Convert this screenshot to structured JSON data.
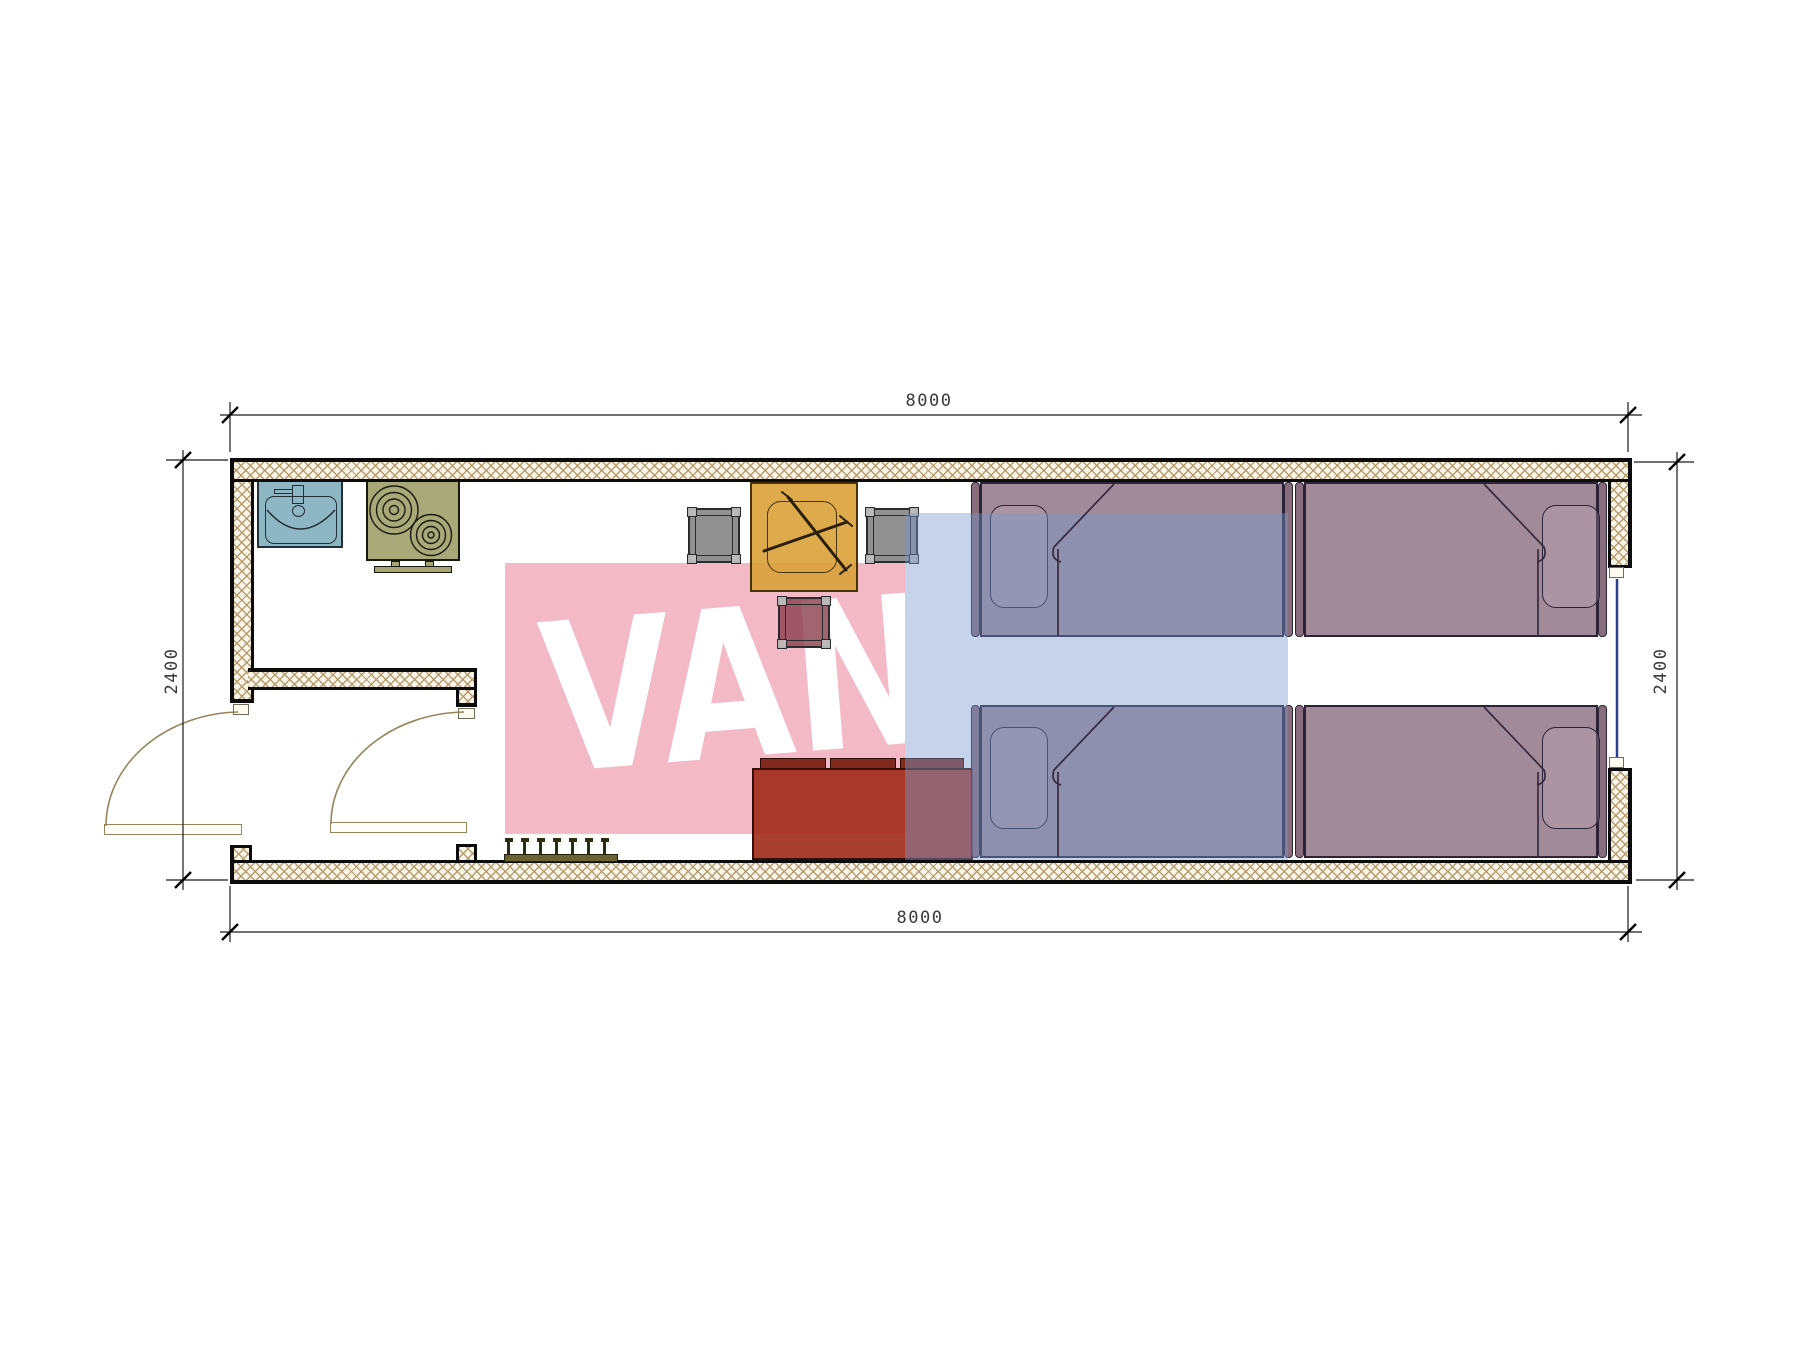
{
  "plan": {
    "title": "container-house-floor-plan",
    "dimensions": {
      "top_mm": "8000",
      "bottom_mm": "8000",
      "left_mm": "2400",
      "right_mm": "2400"
    },
    "watermark": {
      "word": "VANDA",
      "left_text": "VAN",
      "right_text": "DA",
      "pink_block": "#f4b9c6",
      "blue_block_rgba": "rgba(120,150,205,0.42)",
      "letter_color": "#ffffff"
    },
    "palette": {
      "wall_bg": "#faf5e8",
      "wall_hatch": "#b09a6a",
      "ink": "#0c0c0c",
      "pink": "#f4b9c6",
      "sink": "#89b2c0",
      "stove": "#a6a472",
      "table": "#daa238",
      "chair_gray": "#828282",
      "chair_red": "#8c4252",
      "sofa": "#9e2a18",
      "bed": "#8a6e7e",
      "window": "#2e3f93",
      "door": "#96835c",
      "rack": "#6b6332",
      "dim_text": "#3a3a3a"
    },
    "furniture": [
      "kitchen-sink",
      "two-burner-stove",
      "dining-table-with-cutlery",
      "gray-chair-left",
      "gray-chair-right",
      "red-chair",
      "three-seat-sofa",
      "single-bed-1",
      "single-bed-2",
      "single-bed-3",
      "single-bed-4",
      "coat-rack-seven-pegs",
      "entry-door",
      "interior-door",
      "window-right-wall"
    ]
  }
}
